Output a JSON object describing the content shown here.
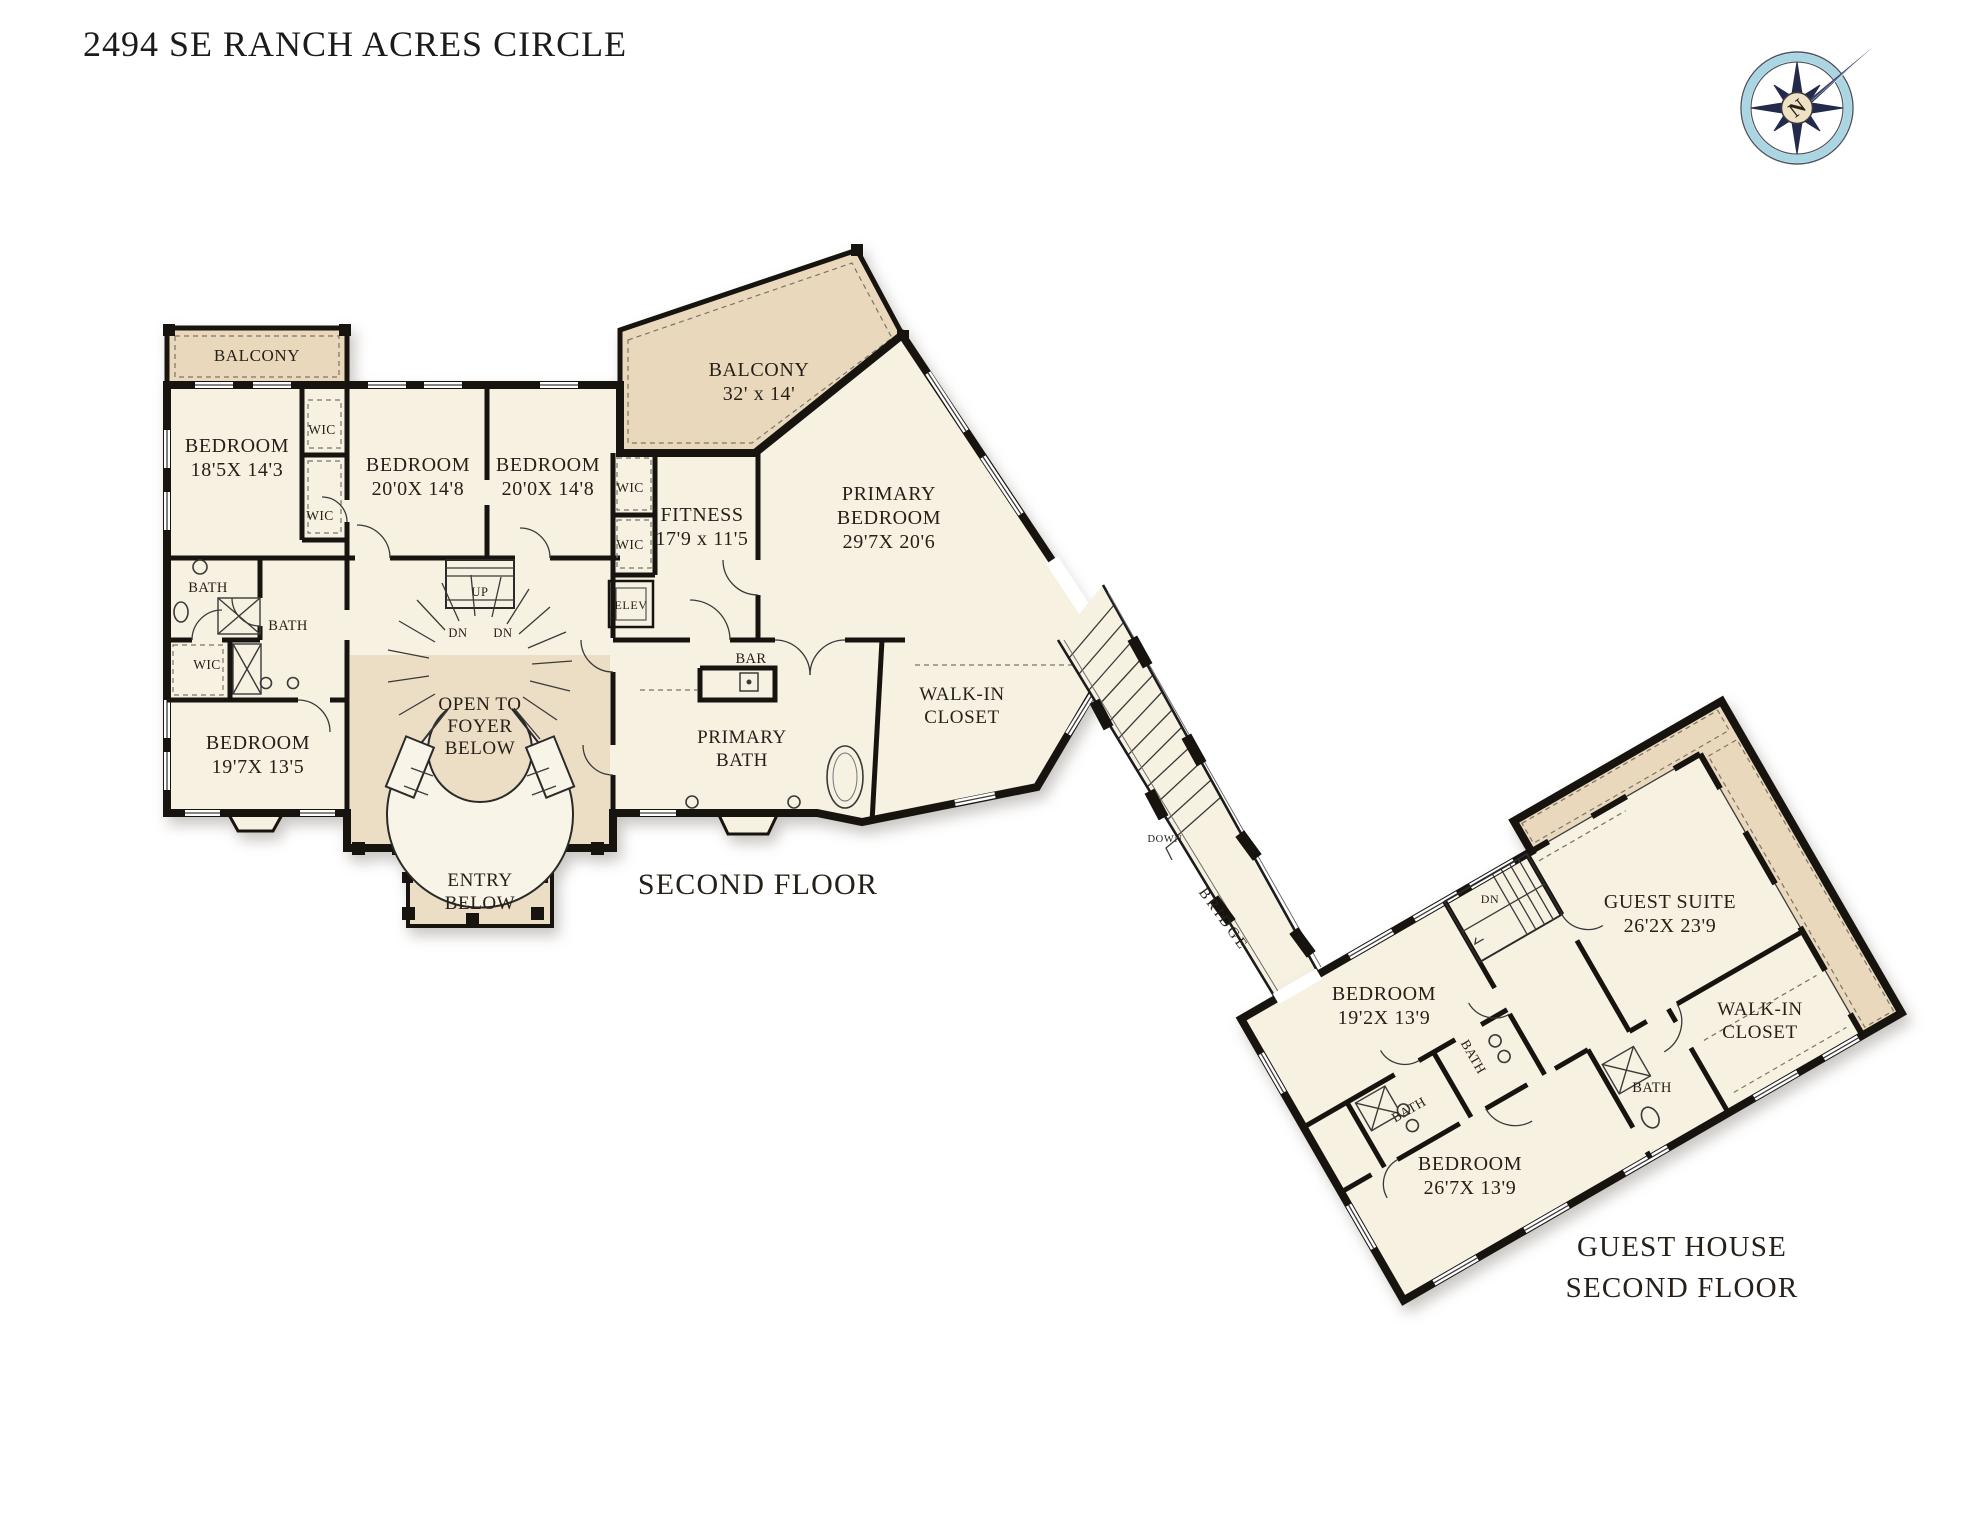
{
  "title": "2494 SE RANCH ACRES CIRCLE",
  "compass": {
    "north_label": "N"
  },
  "main_floor": {
    "floor_label": "SECOND FLOOR",
    "balcony_small": "BALCONY",
    "balcony_large": {
      "name": "BALCONY",
      "dims": "32' x 14'"
    },
    "bedroom1": {
      "name": "BEDROOM",
      "dims": "18'5X 14'3"
    },
    "bedroom2": {
      "name": "BEDROOM",
      "dims": "20'0X 14'8"
    },
    "bedroom3": {
      "name": "BEDROOM",
      "dims": "20'0X 14'8"
    },
    "bedroom4": {
      "name": "BEDROOM",
      "dims": "19'7X 13'5"
    },
    "fitness": {
      "name": "FITNESS",
      "dims": "17'9 x 11'5"
    },
    "primary_bedroom": {
      "name1": "PRIMARY",
      "name2": "BEDROOM",
      "dims": "29'7X 20'6"
    },
    "primary_bath": {
      "name1": "PRIMARY",
      "name2": "BATH"
    },
    "walk_in_closet": {
      "name1": "WALK-IN",
      "name2": "CLOSET"
    },
    "open_to_foyer": {
      "line1": "OPEN TO",
      "line2": "FOYER",
      "line3": "BELOW"
    },
    "entry_below": {
      "line1": "ENTRY",
      "line2": "BELOW"
    },
    "wic": "WIC",
    "bath": "BATH",
    "up": "UP",
    "dn": "DN",
    "elev": "ELEV",
    "bar": "BAR"
  },
  "bridge": {
    "down": "DOWN",
    "name": "BRIDGE"
  },
  "guest_house": {
    "floor_label1": "GUEST HOUSE",
    "floor_label2": "SECOND FLOOR",
    "guest_suite": {
      "name": "GUEST SUITE",
      "dims": "26'2X 23'9"
    },
    "bedroom1": {
      "name": "BEDROOM",
      "dims": "19'2X 13'9"
    },
    "bedroom2": {
      "name": "BEDROOM",
      "dims": "26'7X 13'9"
    },
    "walk_in_closet": {
      "name1": "WALK-IN",
      "name2": "CLOSET"
    },
    "bath": "BATH",
    "dn": "DN"
  },
  "colors": {
    "wall": "#17130e",
    "room_fill": "#f7f1e2",
    "balcony_fill": "#e9d8bc",
    "compass_navy": "#232a4c",
    "compass_ring": "#a9d6e2"
  }
}
